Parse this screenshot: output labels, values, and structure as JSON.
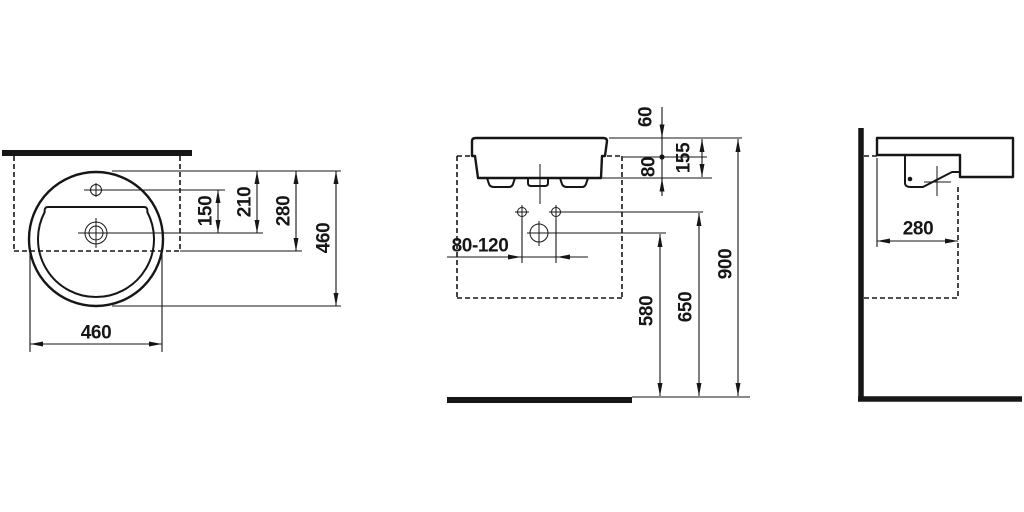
{
  "drawing": {
    "type": "washbasin installation technical drawing, three orthographic views",
    "unit": "mm",
    "colors": {
      "line": "#161616",
      "background": "#ffffff"
    },
    "views": {
      "top": {
        "label": "top view",
        "dims": {
          "tap_hole_to_drain": "150",
          "rim_to_drain": "210",
          "rim_to_counter_front": "280",
          "depth": "460",
          "width": "460"
        }
      },
      "front": {
        "label": "front view",
        "dims": {
          "rim_above_counter": "60",
          "counter_to_underside": "80",
          "basin_height": "155",
          "fixing_hole_spacing": "80-120",
          "drain_center_height": "580",
          "fixing_holes_height": "650",
          "rim_height": "900"
        }
      },
      "side": {
        "label": "side view",
        "dims": {
          "counter_depth": "280"
        }
      }
    }
  }
}
